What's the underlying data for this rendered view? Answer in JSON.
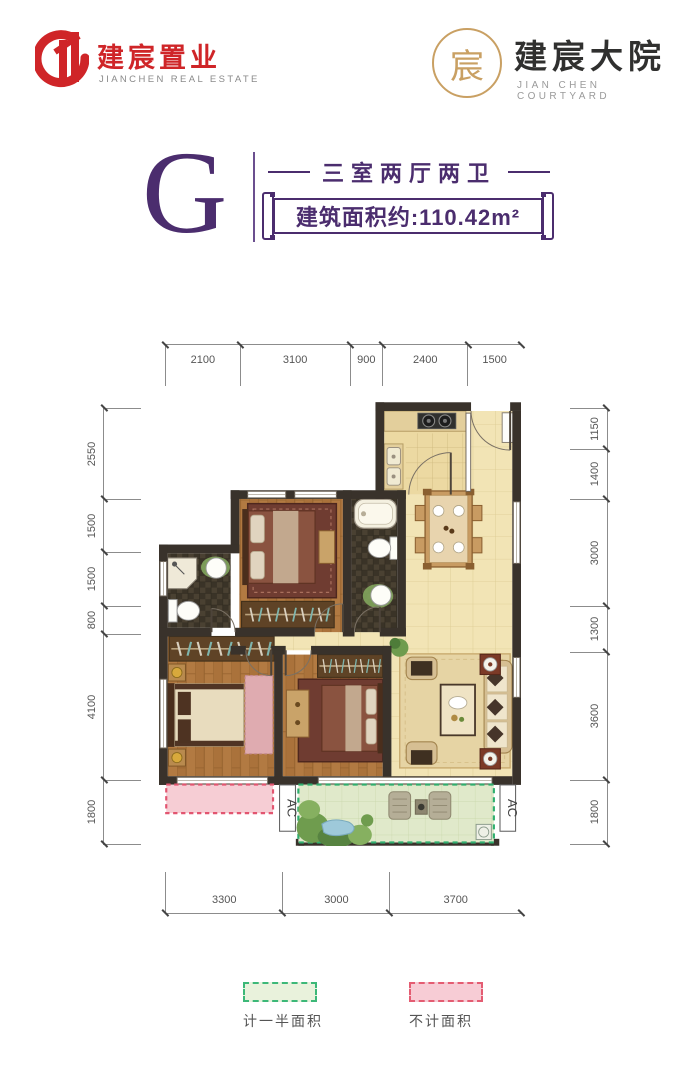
{
  "header": {
    "left_logo": {
      "cn": "建宸置业",
      "en": "JIANCHEN REAL ESTATE",
      "brand_color": "#cf2528"
    },
    "right_logo": {
      "cn": "建宸大院",
      "en": "JIAN CHEN COURTYARD",
      "accent_color": "#c9a063",
      "seal_char": "宸"
    }
  },
  "unit": {
    "letter": "G",
    "layout": "三室两厅两卫",
    "area_label": "建筑面积约:110.42m²",
    "accent_color": "#4b2d6e"
  },
  "dimensions": {
    "top": [
      "2100",
      "3100",
      "900",
      "2400",
      "1500"
    ],
    "left": [
      "2550",
      "1500",
      "1500",
      "800",
      "4100",
      "1800"
    ],
    "right": [
      "1150",
      "1400",
      "3000",
      "1300",
      "3600",
      "1800"
    ],
    "bottom": [
      "3300",
      "3000",
      "3700"
    ]
  },
  "plan": {
    "ac_label": "AC"
  },
  "legend": [
    {
      "label": "计一半面积",
      "fill": "#e9f2dc",
      "border": "#3cb878"
    },
    {
      "label": "不计面积",
      "fill": "#f7ccd5",
      "border": "#e45c72"
    }
  ]
}
